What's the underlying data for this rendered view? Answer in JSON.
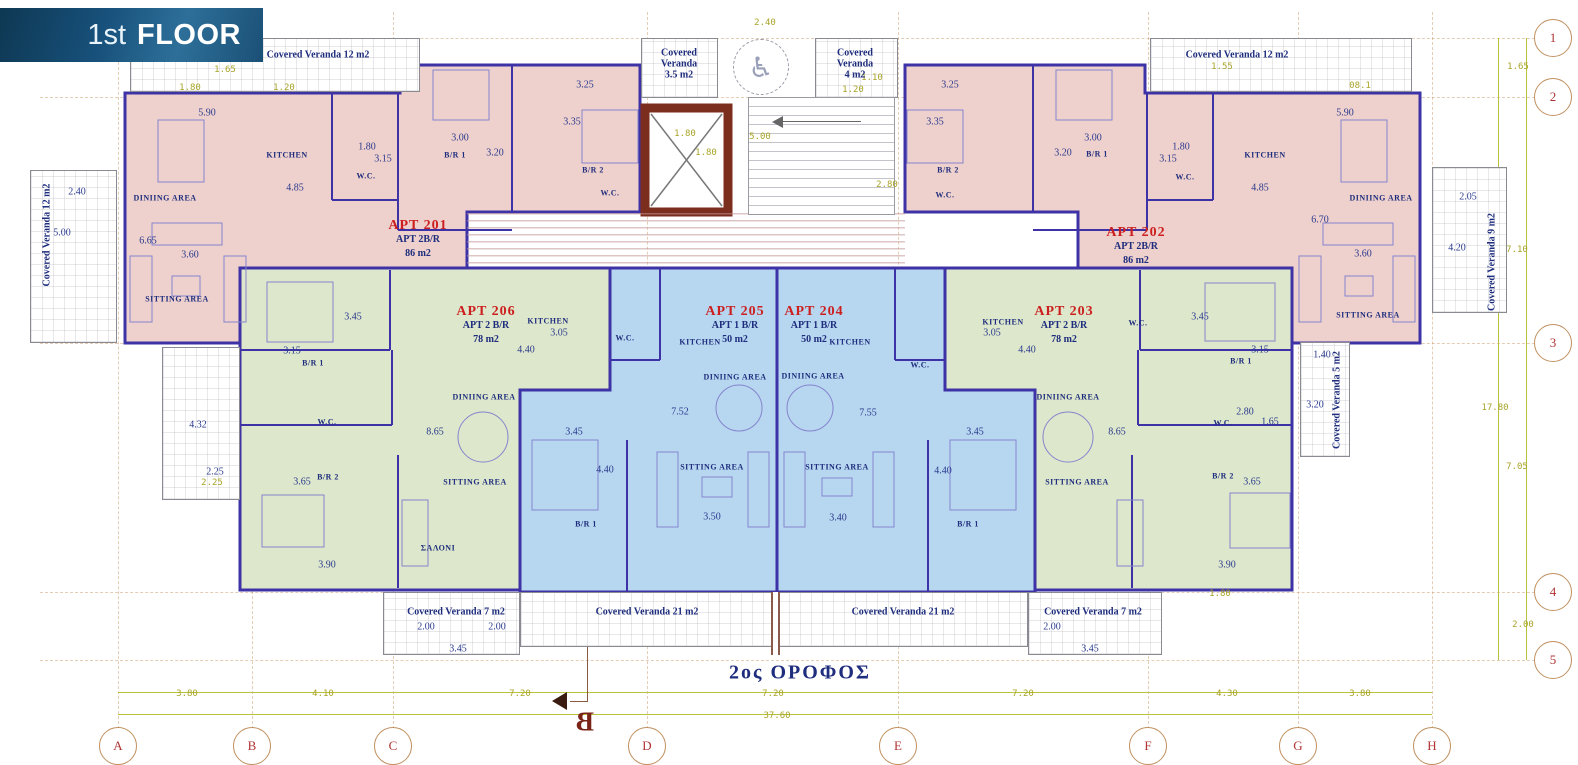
{
  "banner": {
    "prefix": "1st",
    "word": "FLOOR"
  },
  "plan_title_greek": "2ος ΟΡΟΦΟΣ",
  "section_marker": "B",
  "colors": {
    "pink": "#eed0cc",
    "green": "#dde7cb",
    "blue": "#b7d6ef",
    "wall": "#3d33a6",
    "elevator": "#7b2d1e",
    "apt_label": "#cc2020",
    "navy": "#1e2d7d",
    "olive": "#a8a428",
    "tan": "#c09060",
    "bubble": "#b03434"
  },
  "apartments": [
    {
      "name": "APT 201",
      "type": "APT 2B/R",
      "area": "86 m2",
      "x": 418,
      "y": 240
    },
    {
      "name": "APT 202",
      "type": "APT 2B/R",
      "area": "86 m2",
      "x": 1136,
      "y": 247
    },
    {
      "name": "APT 203",
      "type": "APT 2 B/R",
      "area": "78 m2",
      "x": 1064,
      "y": 326
    },
    {
      "name": "APT 204",
      "type": "APT 1 B/R",
      "area": "50 m2",
      "x": 814,
      "y": 326
    },
    {
      "name": "APT 205",
      "type": "APT 1 B/R",
      "area": "50 m2",
      "x": 735,
      "y": 326
    },
    {
      "name": "APT 206",
      "type": "APT 2 B/R",
      "area": "78 m2",
      "x": 486,
      "y": 326
    }
  ],
  "room_labels": [
    [
      "KITCHEN",
      287,
      155
    ],
    [
      "KITCHEN",
      1265,
      155
    ],
    [
      "KITCHEN",
      548,
      321
    ],
    [
      "KITCHEN",
      700,
      342
    ],
    [
      "KITCHEN",
      850,
      342
    ],
    [
      "KITCHEN",
      1003,
      322
    ],
    [
      "DINIING AREA",
      165,
      198
    ],
    [
      "DINIING AREA",
      1381,
      198
    ],
    [
      "DINIING AREA",
      484,
      397
    ],
    [
      "DINIING AREA",
      735,
      377
    ],
    [
      "DINIING AREA",
      813,
      376
    ],
    [
      "DINIING AREA",
      1068,
      397
    ],
    [
      "SITTING AREA",
      177,
      299
    ],
    [
      "SITTING AREA",
      1368,
      315
    ],
    [
      "SITTING AREA",
      475,
      482
    ],
    [
      "SITTING AREA",
      712,
      467
    ],
    [
      "SITTING AREA",
      837,
      467
    ],
    [
      "SITTING AREA",
      1077,
      482
    ],
    [
      "W.C.",
      366,
      176
    ],
    [
      "W.C.",
      610,
      193
    ],
    [
      "W.C.",
      1185,
      177
    ],
    [
      "W.C.",
      945,
      195
    ],
    [
      "W.C.",
      327,
      422
    ],
    [
      "W.C.",
      625,
      338
    ],
    [
      "W.C.",
      920,
      365
    ],
    [
      "W.C.",
      1138,
      323
    ],
    [
      "W.C.",
      1223,
      423
    ],
    [
      "B/R 1",
      455,
      155
    ],
    [
      "B/R 1",
      1097,
      154
    ],
    [
      "B/R 1",
      313,
      363
    ],
    [
      "B/R 1",
      1241,
      361
    ],
    [
      "B/R 1",
      586,
      524
    ],
    [
      "B/R 1",
      968,
      524
    ],
    [
      "B/R 2",
      593,
      170
    ],
    [
      "B/R 2",
      948,
      170
    ],
    [
      "B/R 2",
      328,
      477
    ],
    [
      "B/R 2",
      1223,
      476
    ],
    [
      "ΣΑΛΟΝΙ",
      438,
      548
    ]
  ],
  "dims_navy": [
    [
      "5.90",
      207,
      113
    ],
    [
      "3.25",
      585,
      85
    ],
    [
      "3.35",
      572,
      122
    ],
    [
      "3.00",
      460,
      138
    ],
    [
      "3.20",
      495,
      153
    ],
    [
      "1.80",
      367,
      147
    ],
    [
      "3.15",
      383,
      159
    ],
    [
      "4.85",
      295,
      188
    ],
    [
      "6.65",
      148,
      241
    ],
    [
      "3.60",
      190,
      255
    ],
    [
      "2.40",
      77,
      192
    ],
    [
      "5.00",
      62,
      233
    ],
    [
      "5.90",
      1345,
      113
    ],
    [
      "3.25",
      950,
      85
    ],
    [
      "3.35",
      935,
      122
    ],
    [
      "3.00",
      1093,
      138
    ],
    [
      "3.20",
      1063,
      153
    ],
    [
      "1.80",
      1181,
      147
    ],
    [
      "3.15",
      1168,
      159
    ],
    [
      "4.85",
      1260,
      188
    ],
    [
      "6.70",
      1320,
      220
    ],
    [
      "3.60",
      1363,
      254
    ],
    [
      "2.05",
      1468,
      197
    ],
    [
      "4.20",
      1457,
      248
    ],
    [
      "4.32",
      198,
      425
    ],
    [
      "2.25",
      215,
      472
    ],
    [
      "3.45",
      353,
      317
    ],
    [
      "3.15",
      292,
      351
    ],
    [
      "3.65",
      302,
      482
    ],
    [
      "3.90",
      327,
      565
    ],
    [
      "8.65",
      435,
      432
    ],
    [
      "3.05",
      559,
      333
    ],
    [
      "4.40",
      526,
      350
    ],
    [
      "3.45",
      574,
      432
    ],
    [
      "4.40",
      605,
      470
    ],
    [
      "7.52",
      680,
      412
    ],
    [
      "3.50",
      712,
      517
    ],
    [
      "7.55",
      868,
      413
    ],
    [
      "3.40",
      838,
      518
    ],
    [
      "3.45",
      975,
      432
    ],
    [
      "4.40",
      943,
      471
    ],
    [
      "3.05",
      992,
      333
    ],
    [
      "4.40",
      1027,
      350
    ],
    [
      "8.65",
      1117,
      432
    ],
    [
      "2.80",
      1245,
      412
    ],
    [
      "1.65",
      1270,
      422
    ],
    [
      "3.45",
      1200,
      317
    ],
    [
      "3.15",
      1260,
      350
    ],
    [
      "3.65",
      1252,
      482
    ],
    [
      "3.90",
      1227,
      565
    ],
    [
      "1.40",
      1322,
      355
    ],
    [
      "3.20",
      1315,
      405
    ],
    [
      "2.00",
      426,
      627
    ],
    [
      "2.00",
      497,
      627
    ],
    [
      "3.45",
      458,
      649
    ],
    [
      "2.00",
      1052,
      627
    ],
    [
      "3.45",
      1090,
      649
    ]
  ],
  "dims_olive": [
    [
      "1.65",
      225,
      70
    ],
    [
      "1.80",
      190,
      88
    ],
    [
      "1.20",
      284,
      88
    ],
    [
      "2.40",
      765,
      23
    ],
    [
      "1.10",
      872,
      78
    ],
    [
      "1.20",
      853,
      90
    ],
    [
      "1.80",
      685,
      134
    ],
    [
      "1.80",
      706,
      153
    ],
    [
      "5.00",
      760,
      137
    ],
    [
      "2.80",
      887,
      185
    ],
    [
      "1.55",
      1222,
      67
    ],
    [
      "08.1",
      1360,
      86
    ],
    [
      "1.65",
      1518,
      67
    ],
    [
      "7.10",
      1517,
      250
    ],
    [
      "17.80",
      1495,
      408
    ],
    [
      "7.05",
      1517,
      467
    ],
    [
      "2.00",
      1523,
      625
    ],
    [
      "2.25",
      212,
      483
    ],
    [
      "1.80",
      1220,
      594
    ],
    [
      "3.80",
      187,
      694
    ],
    [
      "4.10",
      323,
      694
    ],
    [
      "7.20",
      520,
      694
    ],
    [
      "7.20",
      773,
      694
    ],
    [
      "7.20",
      1023,
      694
    ],
    [
      "4.30",
      1227,
      694
    ],
    [
      "3.80",
      1360,
      694
    ],
    [
      "37.60",
      777,
      716
    ]
  ],
  "veranda_labels_h": [
    [
      "Covered Veranda 12  m2",
      318,
      55
    ],
    [
      "Covered Veranda 12  m2",
      1237,
      55
    ],
    [
      "Covered Veranda 7 m2",
      456,
      612
    ],
    [
      "Covered Veranda 21 m2",
      647,
      612
    ],
    [
      "Covered Veranda 21 m2",
      903,
      612
    ],
    [
      "Covered Veranda 7 m2",
      1093,
      612
    ]
  ],
  "veranda_labels_multi": [
    {
      "lines": [
        "Covered",
        "Veranda",
        "3.5  m2"
      ],
      "x": 679,
      "y": 64
    },
    {
      "lines": [
        "Covered",
        "Veranda",
        "4  m2"
      ],
      "x": 855,
      "y": 64
    }
  ],
  "veranda_labels_v": [
    [
      "Covered Veranda 12 m2",
      47,
      235
    ],
    [
      "Covered Veranda 9 m2",
      1492,
      262
    ],
    [
      "Covered Veranda 5 m2",
      1337,
      400
    ]
  ],
  "grid_bottom": [
    {
      "label": "A",
      "x": 118
    },
    {
      "label": "B",
      "x": 252
    },
    {
      "label": "C",
      "x": 393
    },
    {
      "label": "D",
      "x": 647
    },
    {
      "label": "E",
      "x": 898
    },
    {
      "label": "F",
      "x": 1148
    },
    {
      "label": "G",
      "x": 1298
    },
    {
      "label": "H",
      "x": 1432
    }
  ],
  "grid_right": [
    {
      "label": "1",
      "y": 38
    },
    {
      "label": "2",
      "y": 97
    },
    {
      "label": "3",
      "y": 343
    },
    {
      "label": "4",
      "y": 592
    },
    {
      "label": "5",
      "y": 660
    }
  ]
}
